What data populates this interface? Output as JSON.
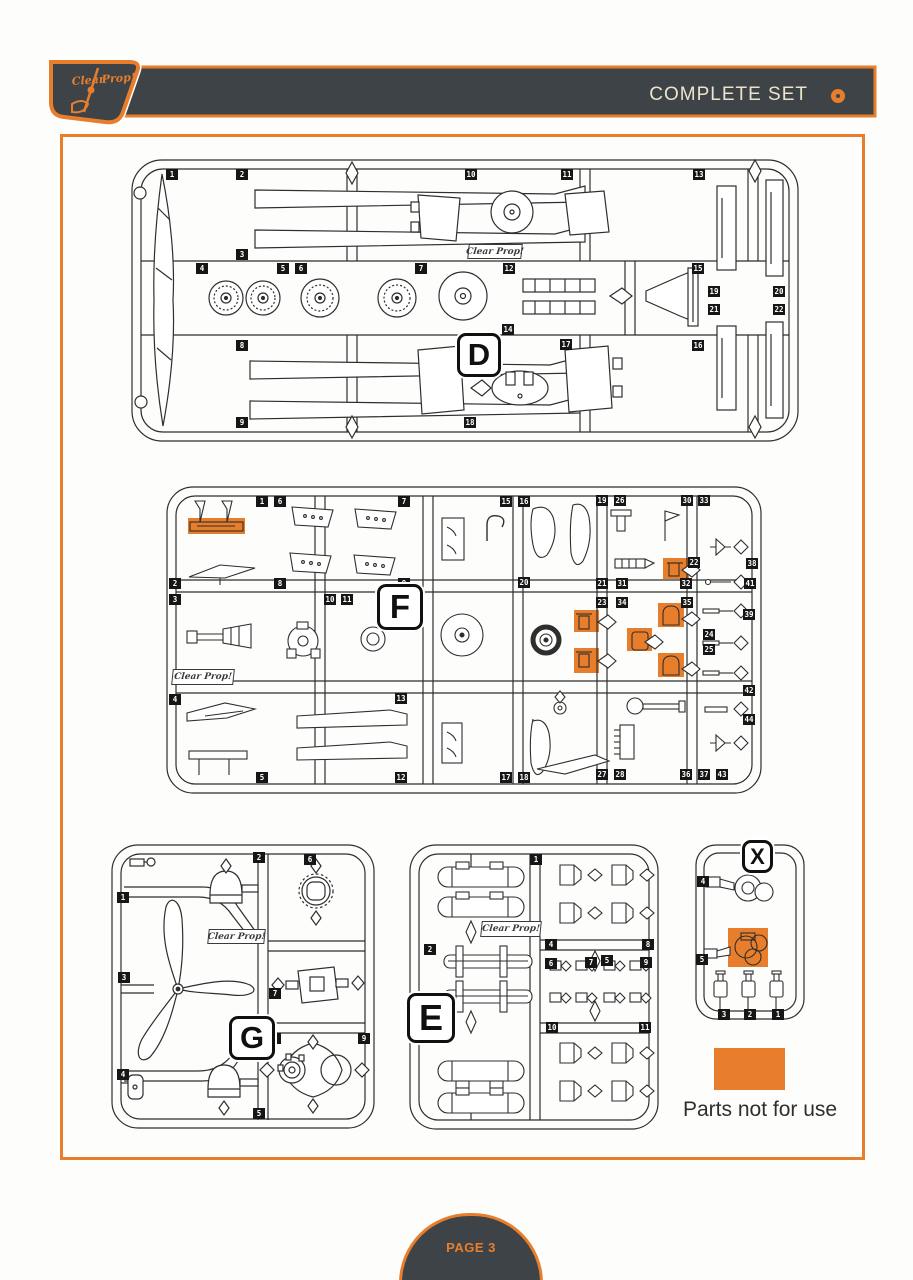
{
  "page": {
    "title": "COMPLETE SET",
    "page_label": "PAGE 3",
    "legend_text": "Parts not for use",
    "brand": "Clear Prop!",
    "colors": {
      "orange": "#E87E2B",
      "dark": "#3E4347",
      "line": "#2e2e2e",
      "cream": "#EBE3CC"
    }
  },
  "sprues": [
    {
      "id": "D",
      "letter": "D",
      "frame": {
        "x": 130,
        "y": 158,
        "w": 670,
        "h": 285
      },
      "badge": {
        "x": 457,
        "y": 333,
        "w": 38,
        "h": 38
      },
      "stamp": {
        "x": 468,
        "y": 244,
        "w": 52,
        "h": 13
      },
      "highlights": [],
      "chips": [
        {
          "n": "1",
          "x": 166,
          "y": 169
        },
        {
          "n": "2",
          "x": 236,
          "y": 169
        },
        {
          "n": "10",
          "x": 465,
          "y": 169
        },
        {
          "n": "11",
          "x": 561,
          "y": 169
        },
        {
          "n": "13",
          "x": 693,
          "y": 169
        },
        {
          "n": "3",
          "x": 236,
          "y": 249
        },
        {
          "n": "4",
          "x": 196,
          "y": 263
        },
        {
          "n": "5",
          "x": 277,
          "y": 263
        },
        {
          "n": "6",
          "x": 295,
          "y": 263
        },
        {
          "n": "7",
          "x": 415,
          "y": 263
        },
        {
          "n": "12",
          "x": 503,
          "y": 263
        },
        {
          "n": "15",
          "x": 692,
          "y": 263
        },
        {
          "n": "14",
          "x": 502,
          "y": 324
        },
        {
          "n": "16",
          "x": 692,
          "y": 340
        },
        {
          "n": "17",
          "x": 560,
          "y": 339
        },
        {
          "n": "8",
          "x": 236,
          "y": 340
        },
        {
          "n": "9",
          "x": 236,
          "y": 417
        },
        {
          "n": "18",
          "x": 464,
          "y": 417
        },
        {
          "n": "19",
          "x": 708,
          "y": 286
        },
        {
          "n": "20",
          "x": 773,
          "y": 286
        },
        {
          "n": "21",
          "x": 708,
          "y": 304
        },
        {
          "n": "22",
          "x": 773,
          "y": 304
        }
      ]
    },
    {
      "id": "F",
      "letter": "F",
      "frame": {
        "x": 165,
        "y": 485,
        "w": 598,
        "h": 310
      },
      "badge": {
        "x": 377,
        "y": 584,
        "w": 40,
        "h": 40
      },
      "stamp": {
        "x": 172,
        "y": 669,
        "w": 60,
        "h": 14
      },
      "highlights": [
        {
          "x": 188,
          "y": 518,
          "w": 57,
          "h": 16
        },
        {
          "x": 663,
          "y": 558,
          "w": 26,
          "h": 21
        },
        {
          "x": 574,
          "y": 610,
          "w": 25,
          "h": 22
        },
        {
          "x": 574,
          "y": 648,
          "w": 25,
          "h": 25
        },
        {
          "x": 627,
          "y": 628,
          "w": 25,
          "h": 23
        },
        {
          "x": 658,
          "y": 603,
          "w": 26,
          "h": 24
        },
        {
          "x": 658,
          "y": 653,
          "w": 26,
          "h": 24
        }
      ],
      "chips": [
        {
          "n": "1",
          "x": 256,
          "y": 496
        },
        {
          "n": "6",
          "x": 274,
          "y": 496
        },
        {
          "n": "7",
          "x": 398,
          "y": 496
        },
        {
          "n": "15",
          "x": 500,
          "y": 496
        },
        {
          "n": "16",
          "x": 518,
          "y": 496
        },
        {
          "n": "19",
          "x": 596,
          "y": 495
        },
        {
          "n": "26",
          "x": 614,
          "y": 495
        },
        {
          "n": "30",
          "x": 681,
          "y": 495
        },
        {
          "n": "33",
          "x": 698,
          "y": 495
        },
        {
          "n": "2",
          "x": 169,
          "y": 578
        },
        {
          "n": "3",
          "x": 169,
          "y": 594
        },
        {
          "n": "4",
          "x": 169,
          "y": 694
        },
        {
          "n": "8",
          "x": 274,
          "y": 578
        },
        {
          "n": "9",
          "x": 398,
          "y": 578
        },
        {
          "n": "10",
          "x": 324,
          "y": 594
        },
        {
          "n": "11",
          "x": 341,
          "y": 594
        },
        {
          "n": "20",
          "x": 518,
          "y": 577
        },
        {
          "n": "21",
          "x": 596,
          "y": 578
        },
        {
          "n": "31",
          "x": 616,
          "y": 578
        },
        {
          "n": "32",
          "x": 680,
          "y": 578
        },
        {
          "n": "22",
          "x": 688,
          "y": 557
        },
        {
          "n": "38",
          "x": 746,
          "y": 558
        },
        {
          "n": "23",
          "x": 596,
          "y": 597
        },
        {
          "n": "34",
          "x": 616,
          "y": 597
        },
        {
          "n": "35",
          "x": 681,
          "y": 597
        },
        {
          "n": "41",
          "x": 744,
          "y": 578
        },
        {
          "n": "24",
          "x": 703,
          "y": 629
        },
        {
          "n": "25",
          "x": 703,
          "y": 644
        },
        {
          "n": "39",
          "x": 743,
          "y": 609
        },
        {
          "n": "13",
          "x": 395,
          "y": 693
        },
        {
          "n": "42",
          "x": 743,
          "y": 685
        },
        {
          "n": "44",
          "x": 743,
          "y": 714
        },
        {
          "n": "5",
          "x": 256,
          "y": 772
        },
        {
          "n": "12",
          "x": 395,
          "y": 772
        },
        {
          "n": "17",
          "x": 500,
          "y": 772
        },
        {
          "n": "18",
          "x": 518,
          "y": 772
        },
        {
          "n": "27",
          "x": 596,
          "y": 769
        },
        {
          "n": "28",
          "x": 614,
          "y": 769
        },
        {
          "n": "36",
          "x": 680,
          "y": 769
        },
        {
          "n": "37",
          "x": 698,
          "y": 769
        },
        {
          "n": "43",
          "x": 716,
          "y": 769
        }
      ]
    },
    {
      "id": "G",
      "letter": "G",
      "frame": {
        "x": 110,
        "y": 843,
        "w": 267,
        "h": 288
      },
      "badge": {
        "x": 229,
        "y": 1016,
        "w": 40,
        "h": 38
      },
      "stamp": {
        "x": 208,
        "y": 929,
        "w": 55,
        "h": 13
      },
      "highlights": [],
      "chips": [
        {
          "n": "2",
          "x": 253,
          "y": 852
        },
        {
          "n": "6",
          "x": 304,
          "y": 854
        },
        {
          "n": "1",
          "x": 117,
          "y": 892
        },
        {
          "n": "3",
          "x": 118,
          "y": 972
        },
        {
          "n": "7",
          "x": 269,
          "y": 988
        },
        {
          "n": "8",
          "x": 269,
          "y": 1033
        },
        {
          "n": "9",
          "x": 358,
          "y": 1033
        },
        {
          "n": "4",
          "x": 117,
          "y": 1069
        },
        {
          "n": "5",
          "x": 253,
          "y": 1108
        }
      ]
    },
    {
      "id": "E",
      "letter": "E",
      "frame": {
        "x": 408,
        "y": 843,
        "w": 252,
        "h": 288
      },
      "badge": {
        "x": 407,
        "y": 993,
        "w": 42,
        "h": 44
      },
      "stamp": {
        "x": 481,
        "y": 921,
        "w": 58,
        "h": 14
      },
      "highlights": [],
      "chips": [
        {
          "n": "1",
          "x": 530,
          "y": 854
        },
        {
          "n": "2",
          "x": 424,
          "y": 944
        },
        {
          "n": "3",
          "x": 424,
          "y": 1034
        },
        {
          "n": "4",
          "x": 545,
          "y": 939
        },
        {
          "n": "8",
          "x": 642,
          "y": 939
        },
        {
          "n": "6",
          "x": 545,
          "y": 958
        },
        {
          "n": "7",
          "x": 585,
          "y": 957
        },
        {
          "n": "5",
          "x": 601,
          "y": 955
        },
        {
          "n": "9",
          "x": 640,
          "y": 957
        },
        {
          "n": "10",
          "x": 546,
          "y": 1022
        },
        {
          "n": "11",
          "x": 639,
          "y": 1022
        }
      ]
    },
    {
      "id": "X",
      "letter": "X",
      "frame": {
        "x": 694,
        "y": 843,
        "w": 112,
        "h": 178
      },
      "badge": {
        "x": 742,
        "y": 840,
        "w": 25,
        "h": 27
      },
      "stamp": null,
      "highlights": [
        {
          "x": 728,
          "y": 928,
          "w": 40,
          "h": 39
        }
      ],
      "chips": [
        {
          "n": "4",
          "x": 697,
          "y": 876
        },
        {
          "n": "5",
          "x": 696,
          "y": 954
        },
        {
          "n": "3",
          "x": 718,
          "y": 1009
        },
        {
          "n": "2",
          "x": 744,
          "y": 1009
        },
        {
          "n": "1",
          "x": 772,
          "y": 1009
        }
      ]
    }
  ]
}
